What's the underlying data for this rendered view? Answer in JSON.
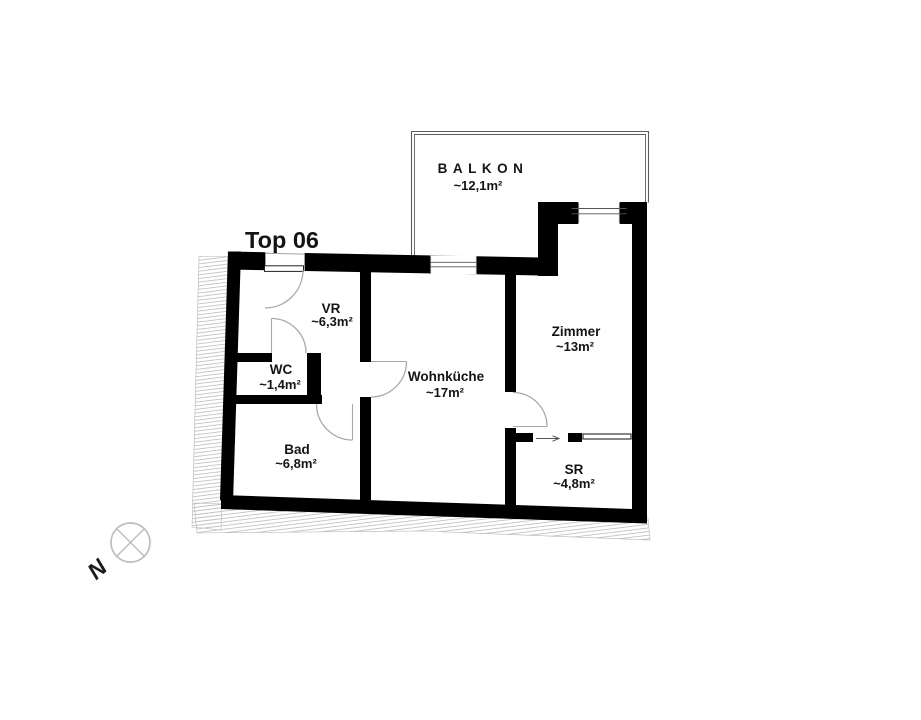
{
  "title": "Top 06",
  "rooms": {
    "balkon": {
      "name": "BALKON",
      "area": "~12,1m²"
    },
    "vr": {
      "name": "VR",
      "area": "~6,3m²"
    },
    "wc": {
      "name": "WC",
      "area": "~1,4m²"
    },
    "bad": {
      "name": "Bad",
      "area": "~6,8m²"
    },
    "wohnkueche": {
      "name": "Wohnküche",
      "area": "~17m²"
    },
    "zimmer": {
      "name": "Zimmer",
      "area": "~13m²"
    },
    "sr": {
      "name": "SR",
      "area": "~4,8m²"
    }
  },
  "compass": {
    "north_label": "N"
  },
  "colors": {
    "wall": "#000000",
    "arc": "#a9a9a9",
    "hatch": "#c4c4c4",
    "railing": "#5c5c5c",
    "text": "#141414"
  }
}
